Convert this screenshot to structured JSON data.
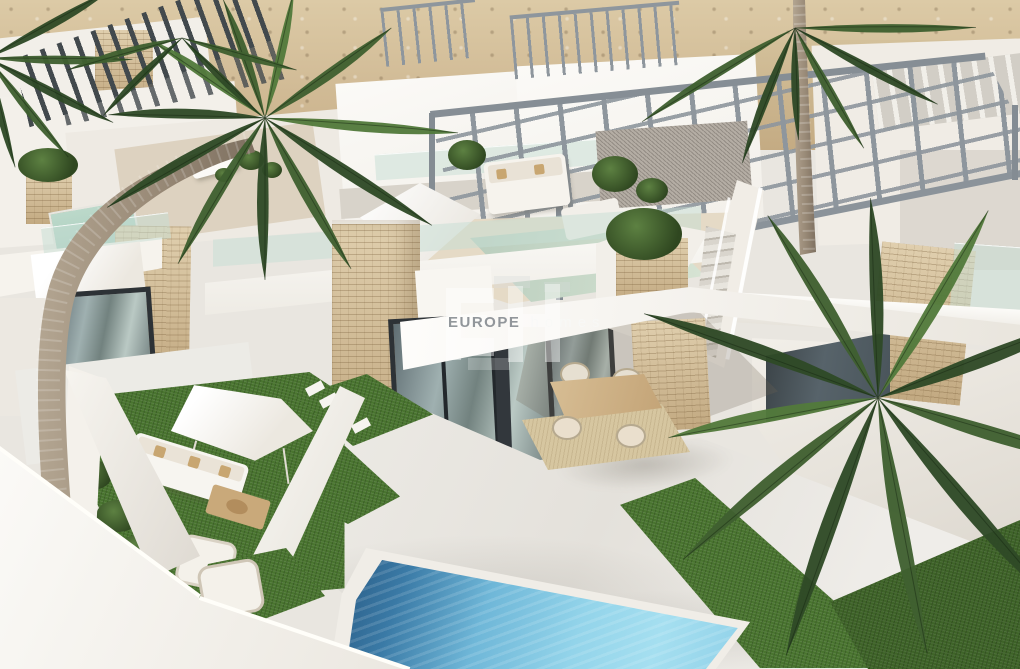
{
  "watermark": {
    "monogram": "EH",
    "brand_bold": "EUROPE",
    "brand_light": "homes"
  },
  "palette": {
    "sand": "#c9b08a",
    "sandLight": "#dccaa6",
    "wall": "#f2efe9",
    "wallBright": "#fbfaf7",
    "wallShade": "#ddd8d0",
    "wallDeep": "#c9c3ba",
    "slatDark": "#42494d",
    "steel": "#8e969d",
    "stone": "#d7c3a2",
    "stoneDark": "#c2a981",
    "glass": "#a9b8b6",
    "frameDark": "#2d3236",
    "railGlass": "#cfe3da",
    "lawn": "#49742f",
    "lawnDark": "#33531f",
    "poolDeep": "#27567f",
    "poolMid": "#6fb7d8",
    "poolLight": "#a5dff0",
    "paving": "#e8e5e0",
    "wood": "#c8a97b",
    "rug": "#d6c6a0",
    "palmDark": "#2f4a26",
    "palmMid": "#3f6030",
    "palmLight": "#527a3b",
    "palmPale": "#648c48",
    "trunk": "#9b8c79",
    "gravel": "#b4ada4"
  }
}
